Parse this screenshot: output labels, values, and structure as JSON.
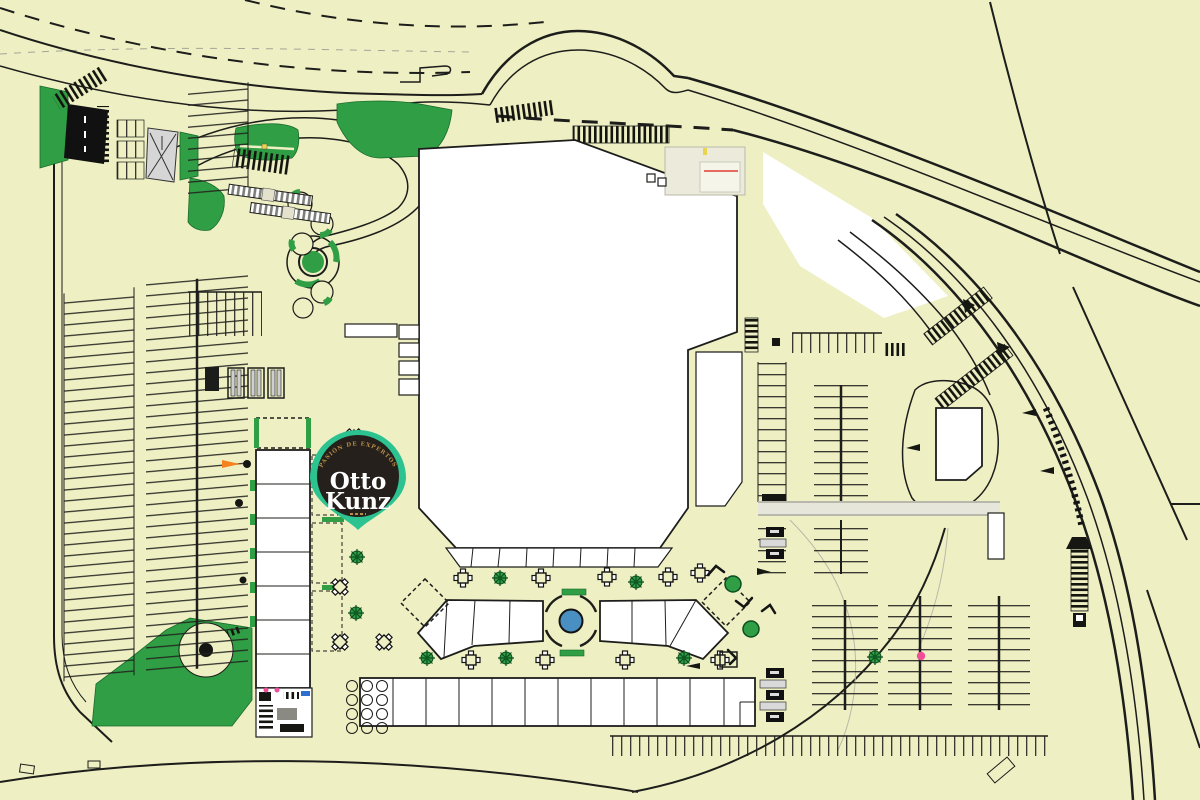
{
  "pin": {
    "tagline": "PASIÓN DE EXPERTOS",
    "name_line1": "Otto",
    "name_line2": "Kunz",
    "ornament": "▬▬"
  },
  "colors": {
    "map-bg": "#eef0c3",
    "line": "#1d1d1b",
    "green": "#2f9e44",
    "green-dark": "#0d4d1f",
    "white": "#ffffff",
    "gray-light": "#d8d8cf",
    "fountain-blue": "#4a8fc2",
    "pin-teal": "#2cc391",
    "pin-dark": "#25201b",
    "pin-gold": "#b78d46",
    "accent-orange": "#f4831f",
    "accent-pink": "#f04f98",
    "accent-yellow": "#e8d44d",
    "accent-red": "#e03c31",
    "accent-blue": "#2f6fd0"
  },
  "features": {
    "pin": "location-pin-icon",
    "fountain": "fountain-circle",
    "trees": "tree-icon",
    "tables": "dining-table-icon",
    "parking": "parking-stalls",
    "mall": "anchor-building",
    "kiosks": "kiosk-row",
    "roundabout": "roundabout",
    "lawn": "lawn-area",
    "roads": "access-roads"
  }
}
